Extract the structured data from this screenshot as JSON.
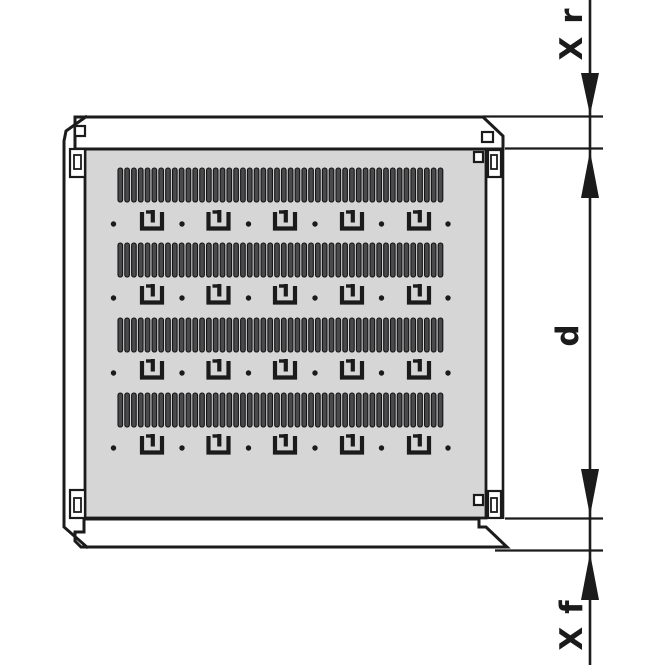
{
  "colors": {
    "ink": "#1b1b1b",
    "panel_fill": "#d6d6d6",
    "rail_fill": "#ffffff",
    "slot_fill": "#4a4a4c",
    "slot_stroke": "#141414",
    "background": "#ffffff"
  },
  "dimensions": {
    "rear_clearance": {
      "label": "X r"
    },
    "usable_depth": {
      "label": "d"
    },
    "front_clearance": {
      "label": "X f"
    }
  },
  "drawing": {
    "vent_bands": {
      "band_tops_y": [
        168,
        243,
        318,
        393
      ],
      "band_height": 34,
      "x_start": 118,
      "pitch": 6.8125,
      "slots_per_band": 48,
      "slot_width": 4.6,
      "slot_corner_radius": 2.1
    },
    "clip_rows": {
      "row_centers_y": [
        223,
        297,
        372,
        447
      ],
      "clip_centers_x": [
        152,
        218.5,
        285,
        352,
        419
      ],
      "dot_centers_x": [
        113.5,
        182,
        248.5,
        315,
        381.5,
        448
      ],
      "dot_radius": 2.7
    }
  }
}
